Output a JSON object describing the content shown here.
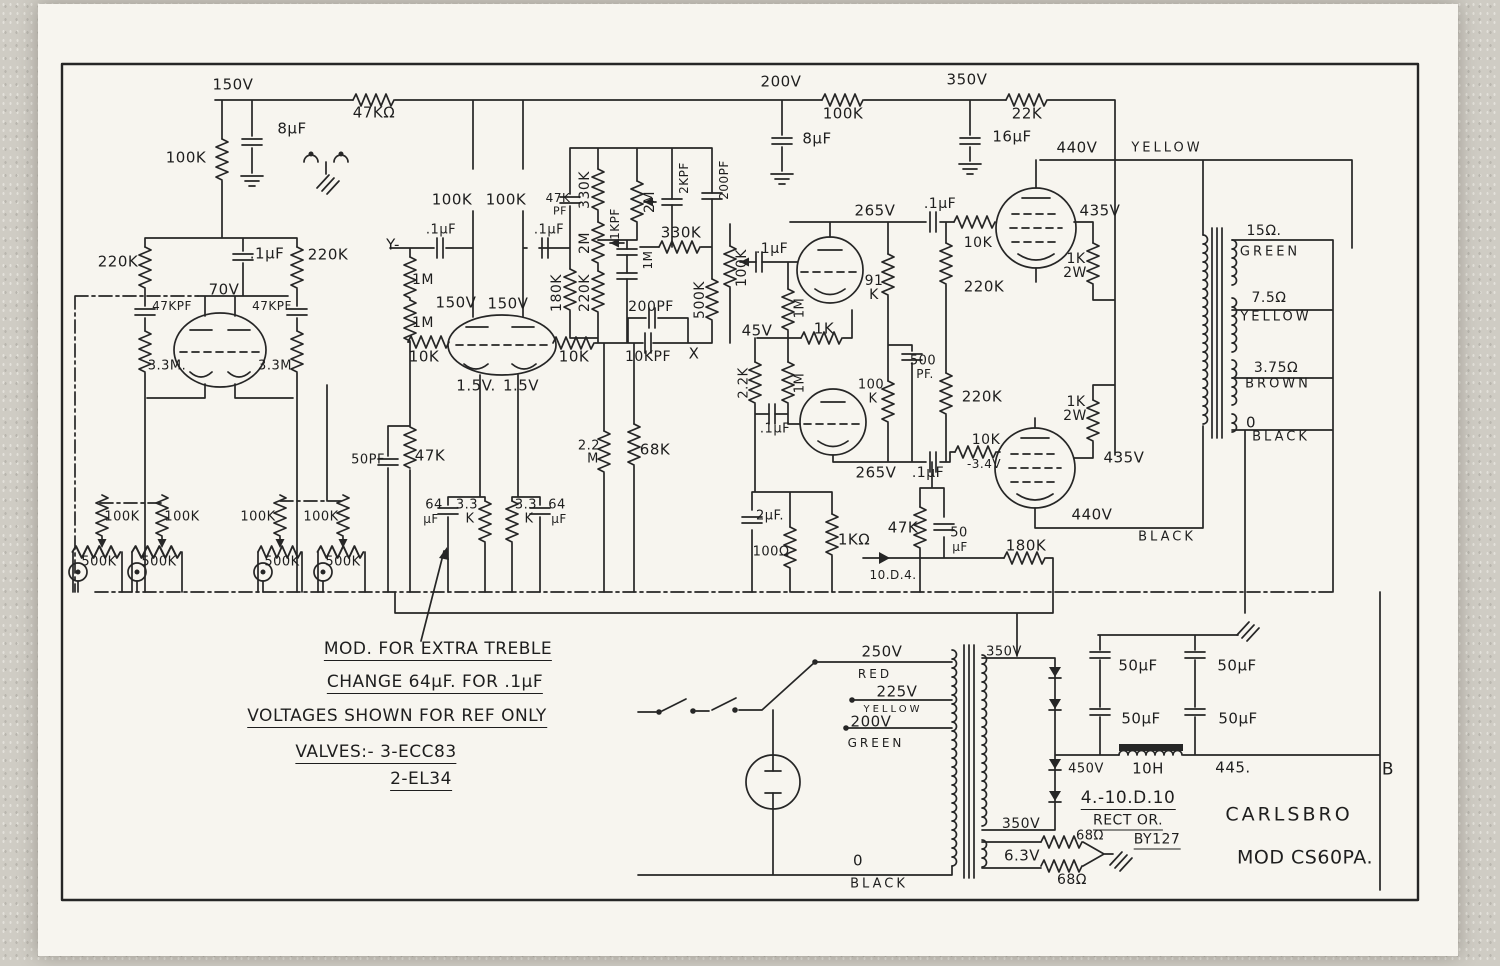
{
  "page": {
    "brand": "CARLSBRO",
    "model": "MOD CS60PA.",
    "notes": [
      "MOD. FOR EXTRA TREBLE",
      "CHANGE 64μF. FOR .1μF",
      "VOLTAGES SHOWN FOR REF ONLY",
      "VALVES:- 3-ECC83",
      "2-EL34",
      "4.-10.D.10",
      "RECT OR.",
      "BY127"
    ]
  },
  "colors": {
    "ink": "#262626",
    "paper": "#f7f5ef",
    "margin": "#cfccc4"
  },
  "labels": [
    {
      "t": "150V",
      "x": 233,
      "y": 85
    },
    {
      "t": "47KΩ",
      "x": 374,
      "y": 113
    },
    {
      "t": "8μF",
      "x": 292,
      "y": 129
    },
    {
      "t": "100K",
      "x": 186,
      "y": 158
    },
    {
      "t": "200V",
      "x": 781,
      "y": 82
    },
    {
      "t": "100K",
      "x": 843,
      "y": 114
    },
    {
      "t": "8μF",
      "x": 817,
      "y": 139
    },
    {
      "t": "350V",
      "x": 967,
      "y": 80
    },
    {
      "t": "22K",
      "x": 1027,
      "y": 114
    },
    {
      "t": "16μF",
      "x": 1012,
      "y": 137
    },
    {
      "t": "440V",
      "x": 1077,
      "y": 148
    },
    {
      "t": "YELLOW",
      "x": 1167,
      "y": 148,
      "sp": 1,
      "fs": 13
    },
    {
      "t": "220K",
      "x": 118,
      "y": 262
    },
    {
      "t": ".1μF",
      "x": 267,
      "y": 254
    },
    {
      "t": "220K",
      "x": 328,
      "y": 255
    },
    {
      "t": "70V",
      "x": 224,
      "y": 290
    },
    {
      "t": "47KPF",
      "x": 172,
      "y": 306,
      "fs": 12
    },
    {
      "t": "47KPF",
      "x": 272,
      "y": 306,
      "fs": 12
    },
    {
      "t": "3.3M.",
      "x": 167,
      "y": 366,
      "fs": 13
    },
    {
      "t": "3.3M",
      "x": 275,
      "y": 366,
      "fs": 13
    },
    {
      "t": "Y-",
      "x": 393,
      "y": 245
    },
    {
      "t": "1M",
      "x": 423,
      "y": 280,
      "fs": 14
    },
    {
      "t": "1M",
      "x": 423,
      "y": 323,
      "fs": 14
    },
    {
      "t": "100K",
      "x": 452,
      "y": 200
    },
    {
      "t": "100K",
      "x": 506,
      "y": 200
    },
    {
      "t": ".1μF",
      "x": 441,
      "y": 230,
      "fs": 13
    },
    {
      "t": ".1μF",
      "x": 549,
      "y": 230,
      "fs": 13
    },
    {
      "t": "47K",
      "x": 558,
      "y": 198,
      "fs": 12
    },
    {
      "t": "PF",
      "x": 560,
      "y": 211,
      "fs": 11
    },
    {
      "t": "150V",
      "x": 456,
      "y": 303
    },
    {
      "t": "150V",
      "x": 508,
      "y": 304
    },
    {
      "t": "10K",
      "x": 424,
      "y": 357
    },
    {
      "t": "10K",
      "x": 574,
      "y": 357
    },
    {
      "t": "1.5V.",
      "x": 476,
      "y": 386
    },
    {
      "t": "1.5V",
      "x": 521,
      "y": 386
    },
    {
      "t": "180K",
      "x": 557,
      "y": 293,
      "r": -90,
      "fs": 14
    },
    {
      "t": "220K",
      "x": 585,
      "y": 293,
      "r": -90,
      "fs": 14
    },
    {
      "t": "330K",
      "x": 585,
      "y": 190,
      "r": -90,
      "fs": 14
    },
    {
      "t": "2M",
      "x": 585,
      "y": 243,
      "r": -90,
      "fs": 14
    },
    {
      "t": "2M",
      "x": 650,
      "y": 202,
      "r": -90,
      "fs": 14
    },
    {
      "t": "1KPF",
      "x": 615,
      "y": 224,
      "r": -90,
      "fs": 12
    },
    {
      "t": "1M",
      "x": 648,
      "y": 260,
      "r": -90,
      "fs": 12
    },
    {
      "t": "2KPF",
      "x": 684,
      "y": 178,
      "r": -90,
      "fs": 12
    },
    {
      "t": "200PF",
      "x": 724,
      "y": 180,
      "r": -90,
      "fs": 12
    },
    {
      "t": "330K",
      "x": 681,
      "y": 233
    },
    {
      "t": "500K",
      "x": 700,
      "y": 300,
      "r": -90,
      "fs": 14
    },
    {
      "t": "100K",
      "x": 742,
      "y": 268,
      "r": -90,
      "fs": 14
    },
    {
      "t": "200PF",
      "x": 651,
      "y": 307,
      "fs": 14
    },
    {
      "t": "10KPF",
      "x": 648,
      "y": 357,
      "fs": 14
    },
    {
      "t": "X",
      "x": 694,
      "y": 354
    },
    {
      "t": ".1μF",
      "x": 772,
      "y": 249,
      "fs": 14
    },
    {
      "t": "50PF",
      "x": 368,
      "y": 460,
      "fs": 13
    },
    {
      "t": "47K",
      "x": 430,
      "y": 456
    },
    {
      "t": "64",
      "x": 434,
      "y": 505,
      "fs": 13
    },
    {
      "t": "μF",
      "x": 431,
      "y": 519,
      "fs": 12
    },
    {
      "t": "3.3",
      "x": 467,
      "y": 505,
      "fs": 13
    },
    {
      "t": "K",
      "x": 470,
      "y": 519,
      "fs": 13
    },
    {
      "t": "3.3",
      "x": 526,
      "y": 505,
      "fs": 13
    },
    {
      "t": "K",
      "x": 529,
      "y": 519,
      "fs": 13
    },
    {
      "t": "64",
      "x": 557,
      "y": 505,
      "fs": 13
    },
    {
      "t": "μF",
      "x": 559,
      "y": 519,
      "fs": 12
    },
    {
      "t": "2.2",
      "x": 589,
      "y": 446,
      "fs": 13
    },
    {
      "t": "M",
      "x": 593,
      "y": 459,
      "fs": 13
    },
    {
      "t": "68K",
      "x": 655,
      "y": 450
    },
    {
      "t": "100K",
      "x": 122,
      "y": 517,
      "fs": 13
    },
    {
      "t": "100K",
      "x": 182,
      "y": 517,
      "fs": 13
    },
    {
      "t": "100K",
      "x": 258,
      "y": 517,
      "fs": 13
    },
    {
      "t": "100K",
      "x": 321,
      "y": 517,
      "fs": 13
    },
    {
      "t": "500K",
      "x": 99,
      "y": 562,
      "fs": 13
    },
    {
      "t": "500K",
      "x": 159,
      "y": 562,
      "fs": 13
    },
    {
      "t": "500K",
      "x": 282,
      "y": 562,
      "fs": 13
    },
    {
      "t": "500K",
      "x": 343,
      "y": 562,
      "fs": 13
    },
    {
      "t": "91",
      "x": 874,
      "y": 281,
      "fs": 14
    },
    {
      "t": "K",
      "x": 874,
      "y": 295,
      "fs": 14
    },
    {
      "t": "1M",
      "x": 800,
      "y": 308,
      "r": -90,
      "fs": 13
    },
    {
      "t": "45V",
      "x": 757,
      "y": 331
    },
    {
      "t": "1K",
      "x": 824,
      "y": 329
    },
    {
      "t": "2.2K",
      "x": 744,
      "y": 383,
      "r": -90,
      "fs": 13
    },
    {
      "t": "1M",
      "x": 800,
      "y": 383,
      "r": -90,
      "fs": 13
    },
    {
      "t": ".1μF",
      "x": 775,
      "y": 429,
      "fs": 13
    },
    {
      "t": "100",
      "x": 871,
      "y": 385,
      "fs": 13
    },
    {
      "t": "K",
      "x": 873,
      "y": 399,
      "fs": 13
    },
    {
      "t": "500",
      "x": 923,
      "y": 361,
      "fs": 13
    },
    {
      "t": "PF.",
      "x": 925,
      "y": 374,
      "fs": 12
    },
    {
      "t": "265V",
      "x": 875,
      "y": 211
    },
    {
      "t": ".1μF",
      "x": 940,
      "y": 204,
      "fs": 14
    },
    {
      "t": "10K",
      "x": 978,
      "y": 243,
      "fs": 14
    },
    {
      "t": "220K",
      "x": 984,
      "y": 287
    },
    {
      "t": "220K",
      "x": 982,
      "y": 397
    },
    {
      "t": "265V",
      "x": 876,
      "y": 473
    },
    {
      "t": ".1μF",
      "x": 928,
      "y": 473,
      "fs": 14
    },
    {
      "t": "10K",
      "x": 986,
      "y": 440,
      "fs": 14
    },
    {
      "t": "-3.4V",
      "x": 984,
      "y": 464,
      "fs": 12
    },
    {
      "t": "435V",
      "x": 1100,
      "y": 211
    },
    {
      "t": "1K",
      "x": 1076,
      "y": 259,
      "fs": 14
    },
    {
      "t": "2W",
      "x": 1075,
      "y": 273,
      "fs": 14
    },
    {
      "t": "1K",
      "x": 1076,
      "y": 402,
      "fs": 14
    },
    {
      "t": "2W",
      "x": 1075,
      "y": 416,
      "fs": 14
    },
    {
      "t": "435V",
      "x": 1124,
      "y": 458
    },
    {
      "t": "440V",
      "x": 1092,
      "y": 515
    },
    {
      "t": "BLACK",
      "x": 1167,
      "y": 537,
      "sp": 1,
      "fs": 13
    },
    {
      "t": "15Ω.",
      "x": 1264,
      "y": 231,
      "fs": 14
    },
    {
      "t": "GREEN",
      "x": 1270,
      "y": 252,
      "sp": 1,
      "fs": 13
    },
    {
      "t": "7.5Ω",
      "x": 1269,
      "y": 298,
      "fs": 14
    },
    {
      "t": "YELLOW",
      "x": 1276,
      "y": 317,
      "sp": 1,
      "fs": 13
    },
    {
      "t": "3.75Ω",
      "x": 1276,
      "y": 368,
      "fs": 14
    },
    {
      "t": "BROWN",
      "x": 1278,
      "y": 384,
      "sp": 1,
      "fs": 13
    },
    {
      "t": "0",
      "x": 1251,
      "y": 423
    },
    {
      "t": "BLACK",
      "x": 1281,
      "y": 437,
      "sp": 1,
      "fs": 13
    },
    {
      "t": "2μF.",
      "x": 770,
      "y": 516,
      "fs": 13
    },
    {
      "t": "100Ω",
      "x": 771,
      "y": 552,
      "fs": 13
    },
    {
      "t": "1KΩ",
      "x": 854,
      "y": 540
    },
    {
      "t": "47K",
      "x": 903,
      "y": 528
    },
    {
      "t": "50",
      "x": 959,
      "y": 533,
      "fs": 13
    },
    {
      "t": "μF",
      "x": 960,
      "y": 547,
      "fs": 12
    },
    {
      "t": "180K",
      "x": 1026,
      "y": 546
    },
    {
      "t": "10.D.4.",
      "x": 893,
      "y": 575,
      "fs": 12
    },
    {
      "t": "250V",
      "x": 882,
      "y": 652
    },
    {
      "t": "RED",
      "x": 875,
      "y": 674,
      "sp": 1,
      "fs": 12
    },
    {
      "t": "225V",
      "x": 897,
      "y": 692
    },
    {
      "t": "YELLOW",
      "x": 893,
      "y": 710,
      "sp": 1,
      "fs": 10
    },
    {
      "t": "200V",
      "x": 871,
      "y": 722
    },
    {
      "t": "GREEN",
      "x": 876,
      "y": 743,
      "sp": 1,
      "fs": 12
    },
    {
      "t": "0",
      "x": 858,
      "y": 861
    },
    {
      "t": "BLACK",
      "x": 879,
      "y": 884,
      "sp": 1,
      "fs": 13
    },
    {
      "t": "350V",
      "x": 1004,
      "y": 652,
      "fs": 13
    },
    {
      "t": "350V",
      "x": 1021,
      "y": 824,
      "fs": 14
    },
    {
      "t": "6.3V",
      "x": 1022,
      "y": 856
    },
    {
      "t": "68Ω",
      "x": 1090,
      "y": 836,
      "fs": 13
    },
    {
      "t": "68Ω",
      "x": 1072,
      "y": 880,
      "fs": 14
    },
    {
      "t": "450V",
      "x": 1086,
      "y": 769,
      "fs": 13
    },
    {
      "t": "10H",
      "x": 1148,
      "y": 769
    },
    {
      "t": "445.",
      "x": 1233,
      "y": 768
    },
    {
      "t": "B",
      "x": 1388,
      "y": 770,
      "fs": 17
    },
    {
      "t": "50μF",
      "x": 1138,
      "y": 666
    },
    {
      "t": "50μF",
      "x": 1237,
      "y": 666
    },
    {
      "t": "50μF",
      "x": 1141,
      "y": 719
    },
    {
      "t": "50μF",
      "x": 1238,
      "y": 719
    },
    {
      "t": "4.-10.D.10",
      "x": 1128,
      "y": 800,
      "u": 1,
      "fs": 17,
      "n": "rectifier-note-line-1"
    },
    {
      "t": "RECT OR.",
      "x": 1128,
      "y": 822,
      "u": 1,
      "fs": 14,
      "n": "rectifier-note-line-2"
    },
    {
      "t": "BY127",
      "x": 1157,
      "y": 841,
      "u": 1,
      "fs": 14,
      "n": "rectifier-note-line-3"
    },
    {
      "t": "CARLSBRO",
      "x": 1289,
      "y": 815,
      "sp": 1,
      "fs": 19,
      "n": "brand-name"
    },
    {
      "t": "MOD CS60PA.",
      "x": 1305,
      "y": 858,
      "fs": 19,
      "n": "model-number"
    },
    {
      "t": "MOD. FOR EXTRA TREBLE",
      "x": 438,
      "y": 651,
      "u": 1,
      "fs": 17,
      "n": "note-mod-treble"
    },
    {
      "t": "CHANGE 64μF. FOR .1μF",
      "x": 435,
      "y": 684,
      "u": 1,
      "fs": 17,
      "n": "note-change-cap"
    },
    {
      "t": "VOLTAGES SHOWN FOR REF ONLY",
      "x": 397,
      "y": 718,
      "u": 1,
      "fs": 17,
      "n": "note-voltages"
    },
    {
      "t": "VALVES:- 3-ECC83",
      "x": 376,
      "y": 754,
      "u": 1,
      "fs": 17,
      "n": "note-valves-1"
    },
    {
      "t": "2-EL34",
      "x": 421,
      "y": 781,
      "u": 1,
      "fs": 17,
      "n": "note-valves-2"
    }
  ]
}
